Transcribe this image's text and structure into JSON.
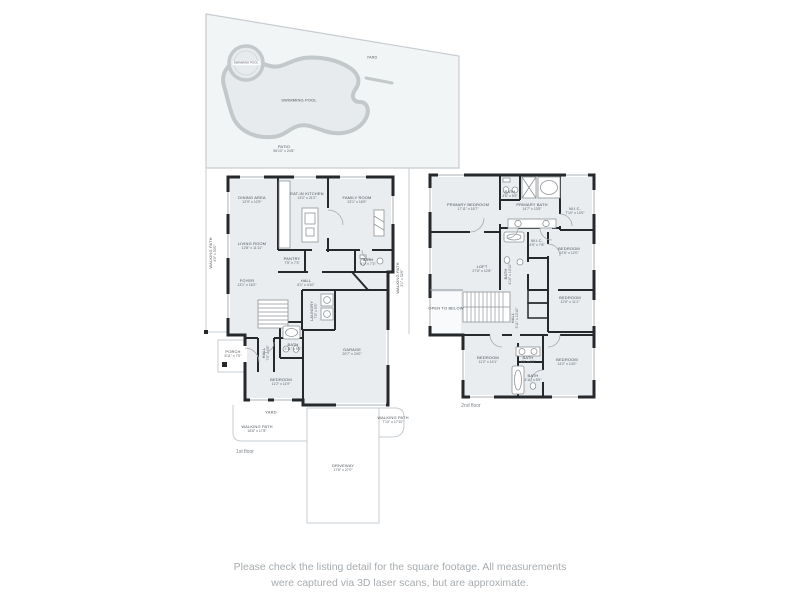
{
  "colors": {
    "wall": "#26292c",
    "room_fill": "#e9edf0",
    "site_line": "#c7ccd0",
    "yard_fill": "#f2f5f6",
    "pool_fill": "#e7ebee",
    "pool_edge": "#c3c8cb",
    "label_text": "#4c5257",
    "disclaimer_text": "#a7acb0"
  },
  "site": {
    "yard": {
      "name": "YARD"
    },
    "spa": {
      "name": "SWIMMING POOL"
    },
    "pool": {
      "name": "SWIMMING POOL"
    },
    "patio": {
      "name": "PATIO",
      "dims": "56'10\" x 24'8\""
    }
  },
  "floor1": {
    "caption": "1st floor",
    "rooms": {
      "dining": {
        "name": "DINING AREA",
        "dims": "12'9\" x 12'9\""
      },
      "kitchen": {
        "name": "EAT-IN KITCHEN",
        "dims": "13'2\" x 21'2\""
      },
      "family": {
        "name": "FAMILY ROOM",
        "dims": "23'1\" x 18'9\""
      },
      "living": {
        "name": "LIVING ROOM",
        "dims": "12'8\" x 11'11\""
      },
      "foyer": {
        "name": "FOYER",
        "dims": "13'1\" x 16'2\""
      },
      "pantry": {
        "name": "PANTRY",
        "dims": "7'5\" x 7'3\""
      },
      "hall_upper": {
        "name": "HALL",
        "dims": "8'1\" x 4'10\""
      },
      "powder": {
        "name": "BATH",
        "dims": "4'0\" x 7'3\""
      },
      "laundry": {
        "name": "LAUNDRY",
        "dims": "7'0\" x 5'5\""
      },
      "garage": {
        "name": "GARAGE",
        "dims": "20'7\" x 24'0\""
      },
      "hall_lower": {
        "name": "HALL",
        "dims": "7'0\" x 4'8\""
      },
      "bath": {
        "name": "BATH",
        "dims": "5'11\" x 8'0\""
      },
      "bedroom": {
        "name": "BEDROOM",
        "dims": "11'2\" x 11'9\""
      }
    },
    "outdoor": {
      "porch": {
        "name": "PORCH",
        "dims": "8'11\" x 7'0\""
      },
      "yard": {
        "name": "YARD"
      },
      "wp_left": {
        "name": "WALKING PATH",
        "dims": "4'0\" x 53'0\""
      },
      "wp_right": {
        "name": "WALKING PATH",
        "dims": "3'1\" x 52'6\""
      },
      "wp_bl": {
        "name": "WALKING PATH",
        "dims": "18'8\" x 17'8\""
      },
      "wp_br": {
        "name": "WALKING PATH",
        "dims": "7'10\" x 17'10\""
      },
      "driveway": {
        "name": "DRIVEWAY",
        "dims": "17'8\" x 27'0\""
      }
    }
  },
  "floor2": {
    "caption": "2nd floor",
    "rooms": {
      "primary_bedroom": {
        "name": "PRIMARY BEDROOM",
        "dims": "17'11\" x 16'7\""
      },
      "bath_top": {
        "name": "BATH",
        "dims": "4'6\" x 5'5\""
      },
      "primary_bath": {
        "name": "PRIMARY BATH",
        "dims": "14'7\" x 13'5\""
      },
      "wic_large": {
        "name": "W.I.C.",
        "dims": "7'10\" x 13'0\""
      },
      "wic_small": {
        "name": "W.I.C.",
        "dims": "4'5\" x 7'8\""
      },
      "bath_mid": {
        "name": "BATH",
        "dims": "4'10\" x 10'10\""
      },
      "bedroom_mid": {
        "name": "BEDROOM",
        "dims": "12'5\" x 12'0\""
      },
      "loft": {
        "name": "LOFT",
        "dims": "27'6\" x 12'6\""
      },
      "open_below": {
        "name": "OPEN TO BELOW"
      },
      "hall": {
        "name": "HALL",
        "dims": "3'11\" x 13'10\""
      },
      "bedroom_top_right": {
        "name": "BEDROOM",
        "dims": "12'0\" x 11'1\""
      },
      "bedroom_left": {
        "name": "BEDROOM",
        "dims": "11'2\" x 14'1\""
      },
      "bath_c1": {
        "name": "BATH",
        "dims": "4'5\" x 5'1\""
      },
      "bath_c2": {
        "name": "BATH",
        "dims": "4'11\" x 8'5\""
      },
      "bedroom_right": {
        "name": "BEDROOM",
        "dims": "14'2\" x 14'0\""
      }
    }
  },
  "disclaimer": {
    "line1": "Please check the listing detail for the square footage. All measurements",
    "line2": "were captured via 3D laser scans, but are approximate."
  }
}
